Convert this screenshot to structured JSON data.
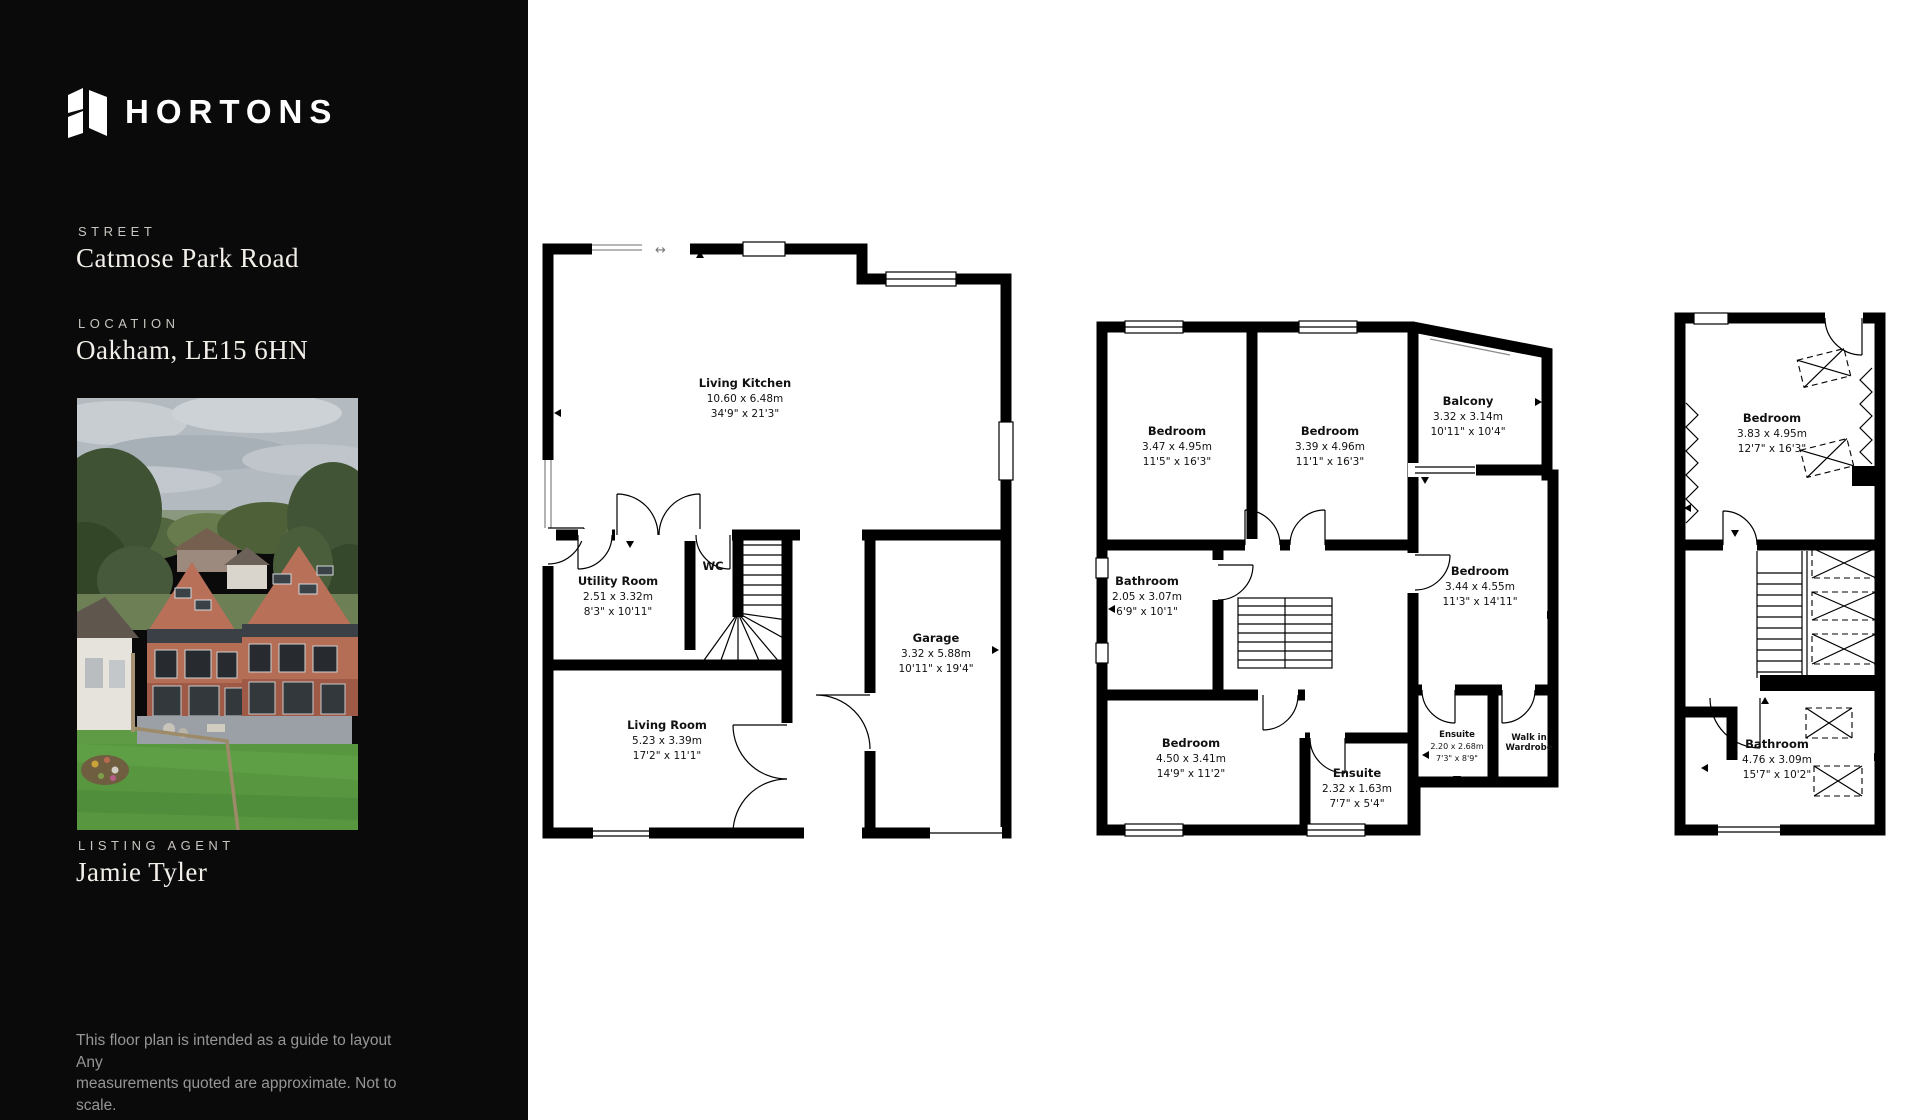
{
  "brand": {
    "name": "HORTONS"
  },
  "sidebar": {
    "street_label": "STREET",
    "street_value": "Catmose Park Road",
    "location_label": "LOCATION",
    "location_value": "Oakham, LE15 6HN",
    "agent_label": "LISTING AGENT",
    "agent_value": "Jamie Tyler",
    "disclaimer_line1": "This floor plan is intended  as a guide to layout Any",
    "disclaimer_line2": "measurements quoted are approximate. Not to scale."
  },
  "plans": {
    "ground": {
      "rooms": {
        "living_kitchen": {
          "name": "Living Kitchen",
          "metric": "10.60 x 6.48m",
          "imperial": "34'9\" x 21'3\""
        },
        "utility": {
          "name": "Utility Room",
          "metric": "2.51 x 3.32m",
          "imperial": "8'3\" x 10'11\""
        },
        "wc": {
          "name": "WC"
        },
        "garage": {
          "name": "Garage",
          "metric": "3.32 x 5.88m",
          "imperial": "10'11\" x 19'4\""
        },
        "living_room": {
          "name": "Living Room",
          "metric": "5.23 x 3.39m",
          "imperial": "17'2\" x 11'1\""
        }
      }
    },
    "first": {
      "rooms": {
        "bedroom1": {
          "name": "Bedroom",
          "metric": "3.47 x 4.95m",
          "imperial": "11'5\" x 16'3\""
        },
        "bedroom2": {
          "name": "Bedroom",
          "metric": "3.39 x 4.96m",
          "imperial": "11'1\" x 16'3\""
        },
        "balcony": {
          "name": "Balcony",
          "metric": "3.32 x 3.14m",
          "imperial": "10'11\" x 10'4\""
        },
        "bathroom": {
          "name": "Bathroom",
          "metric": "2.05 x 3.07m",
          "imperial": "6'9\" x 10'1\""
        },
        "bedroom3": {
          "name": "Bedroom",
          "metric": "3.44 x 4.55m",
          "imperial": "11'3\" x 14'11\""
        },
        "bedroom4": {
          "name": "Bedroom",
          "metric": "4.50 x 3.41m",
          "imperial": "14'9\" x 11'2\""
        },
        "ensuite1": {
          "name": "Ensuite",
          "metric": "2.32 x 1.63m",
          "imperial": "7'7\" x 5'4\""
        },
        "ensuite2": {
          "name": "Ensuite",
          "metric": "2.20 x 2.68m",
          "imperial": "7'3\" x 8'9\""
        },
        "wardrobe": {
          "name": "Walk in Wardrobe"
        }
      }
    },
    "second": {
      "rooms": {
        "bedroom": {
          "name": "Bedroom",
          "metric": "3.83 x 4.95m",
          "imperial": "12'7\" x 16'3\""
        },
        "bathroom": {
          "name": "Bathroom",
          "metric": "4.76 x 3.09m",
          "imperial": "15'7\" x 10'2\""
        }
      }
    }
  }
}
